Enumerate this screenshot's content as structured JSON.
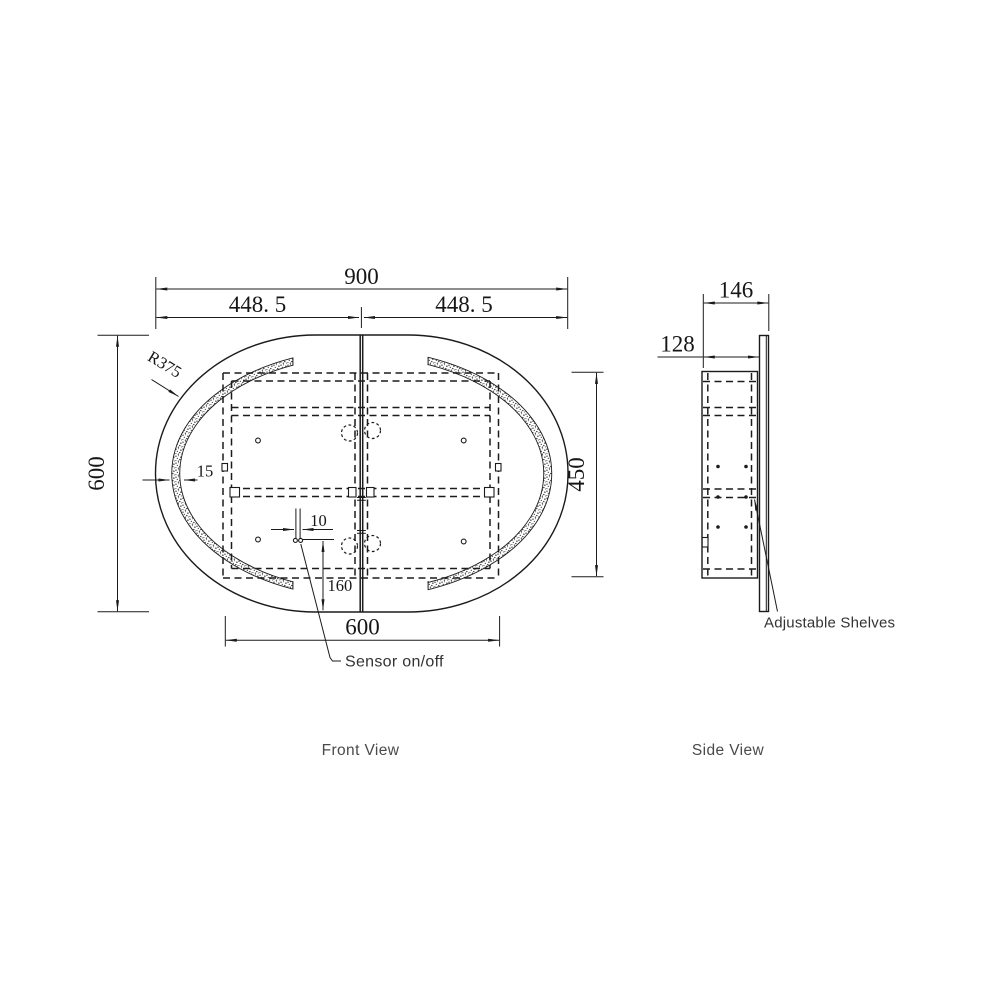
{
  "drawing": {
    "front": {
      "view_label": "Front View",
      "dim_overall_width": "900",
      "dim_half_width_left": "448. 5",
      "dim_half_width_right": "448. 5",
      "dim_overall_height": "600",
      "dim_cabinet_height": "450",
      "dim_cabinet_width": "600",
      "dim_corner_radius": "R375",
      "dim_led_band_width": "15",
      "dim_sensor_offset": "10",
      "dim_sensor_height": "160",
      "label_sensor": "Sensor on/off"
    },
    "side": {
      "view_label": "Side View",
      "dim_total_depth": "146",
      "dim_cabinet_depth": "128",
      "label_shelves": "Adjustable Shelves"
    },
    "colors": {
      "line": "#1b1b1b",
      "annotation_text": "#333333",
      "view_label_text": "#4a4a4a",
      "background": "#ffffff"
    }
  }
}
